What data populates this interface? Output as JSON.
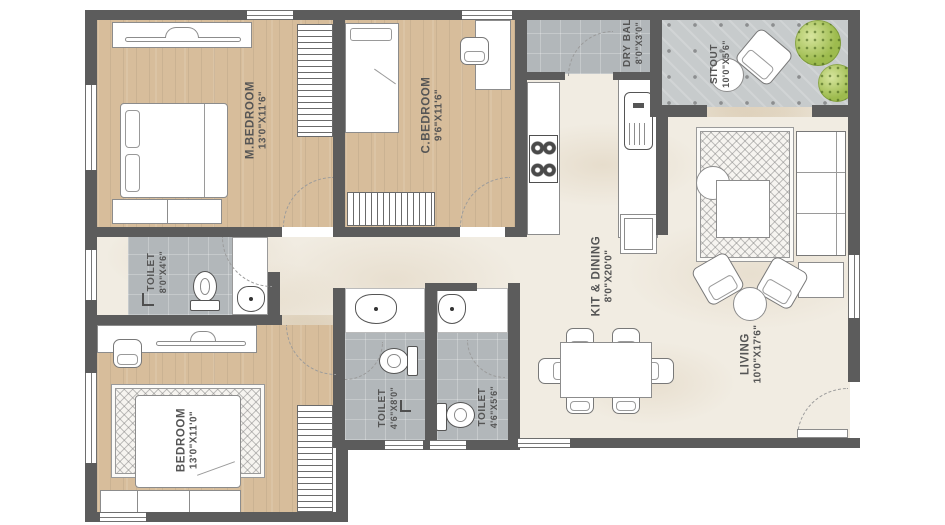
{
  "plan": {
    "title": "2 BHK Apartment Floor Plan",
    "rooms": {
      "m_bedroom": {
        "name": "M.BEDROOM",
        "dims": "13'0\"X11'6\""
      },
      "c_bedroom": {
        "name": "C.BEDROOM",
        "dims": "9'6\"X11'6\""
      },
      "dry_bal": {
        "name": "DRY BAL",
        "dims": "8'0\"X3'0\""
      },
      "sitout": {
        "name": "SITOUT",
        "dims": "10'0\"X5'6\""
      },
      "kit_dining": {
        "name": "KIT & DINING",
        "dims": "8'0\"X20'0\""
      },
      "living": {
        "name": "LIVING",
        "dims": "10'0\"X17'6\""
      },
      "toilet_top": {
        "name": "TOILET",
        "dims": "8'0\"X4'6\""
      },
      "bedroom": {
        "name": "BEDROOM",
        "dims": "13'0\"X11'0\""
      },
      "toilet_left": {
        "name": "TOILET",
        "dims": "4'6\"X8'0\""
      },
      "toilet_right": {
        "name": "TOILET",
        "dims": "4'6\"X5'6\""
      }
    },
    "colors": {
      "wall": "#5c5c5c",
      "wood_floor": "#d7bd9b",
      "tile_gray": "#b2b7ba",
      "marble": "#f1ece2",
      "sitout_tile": "#c7cbcc",
      "plant_green": "#9dbb4e",
      "label_text": "#555555"
    }
  }
}
